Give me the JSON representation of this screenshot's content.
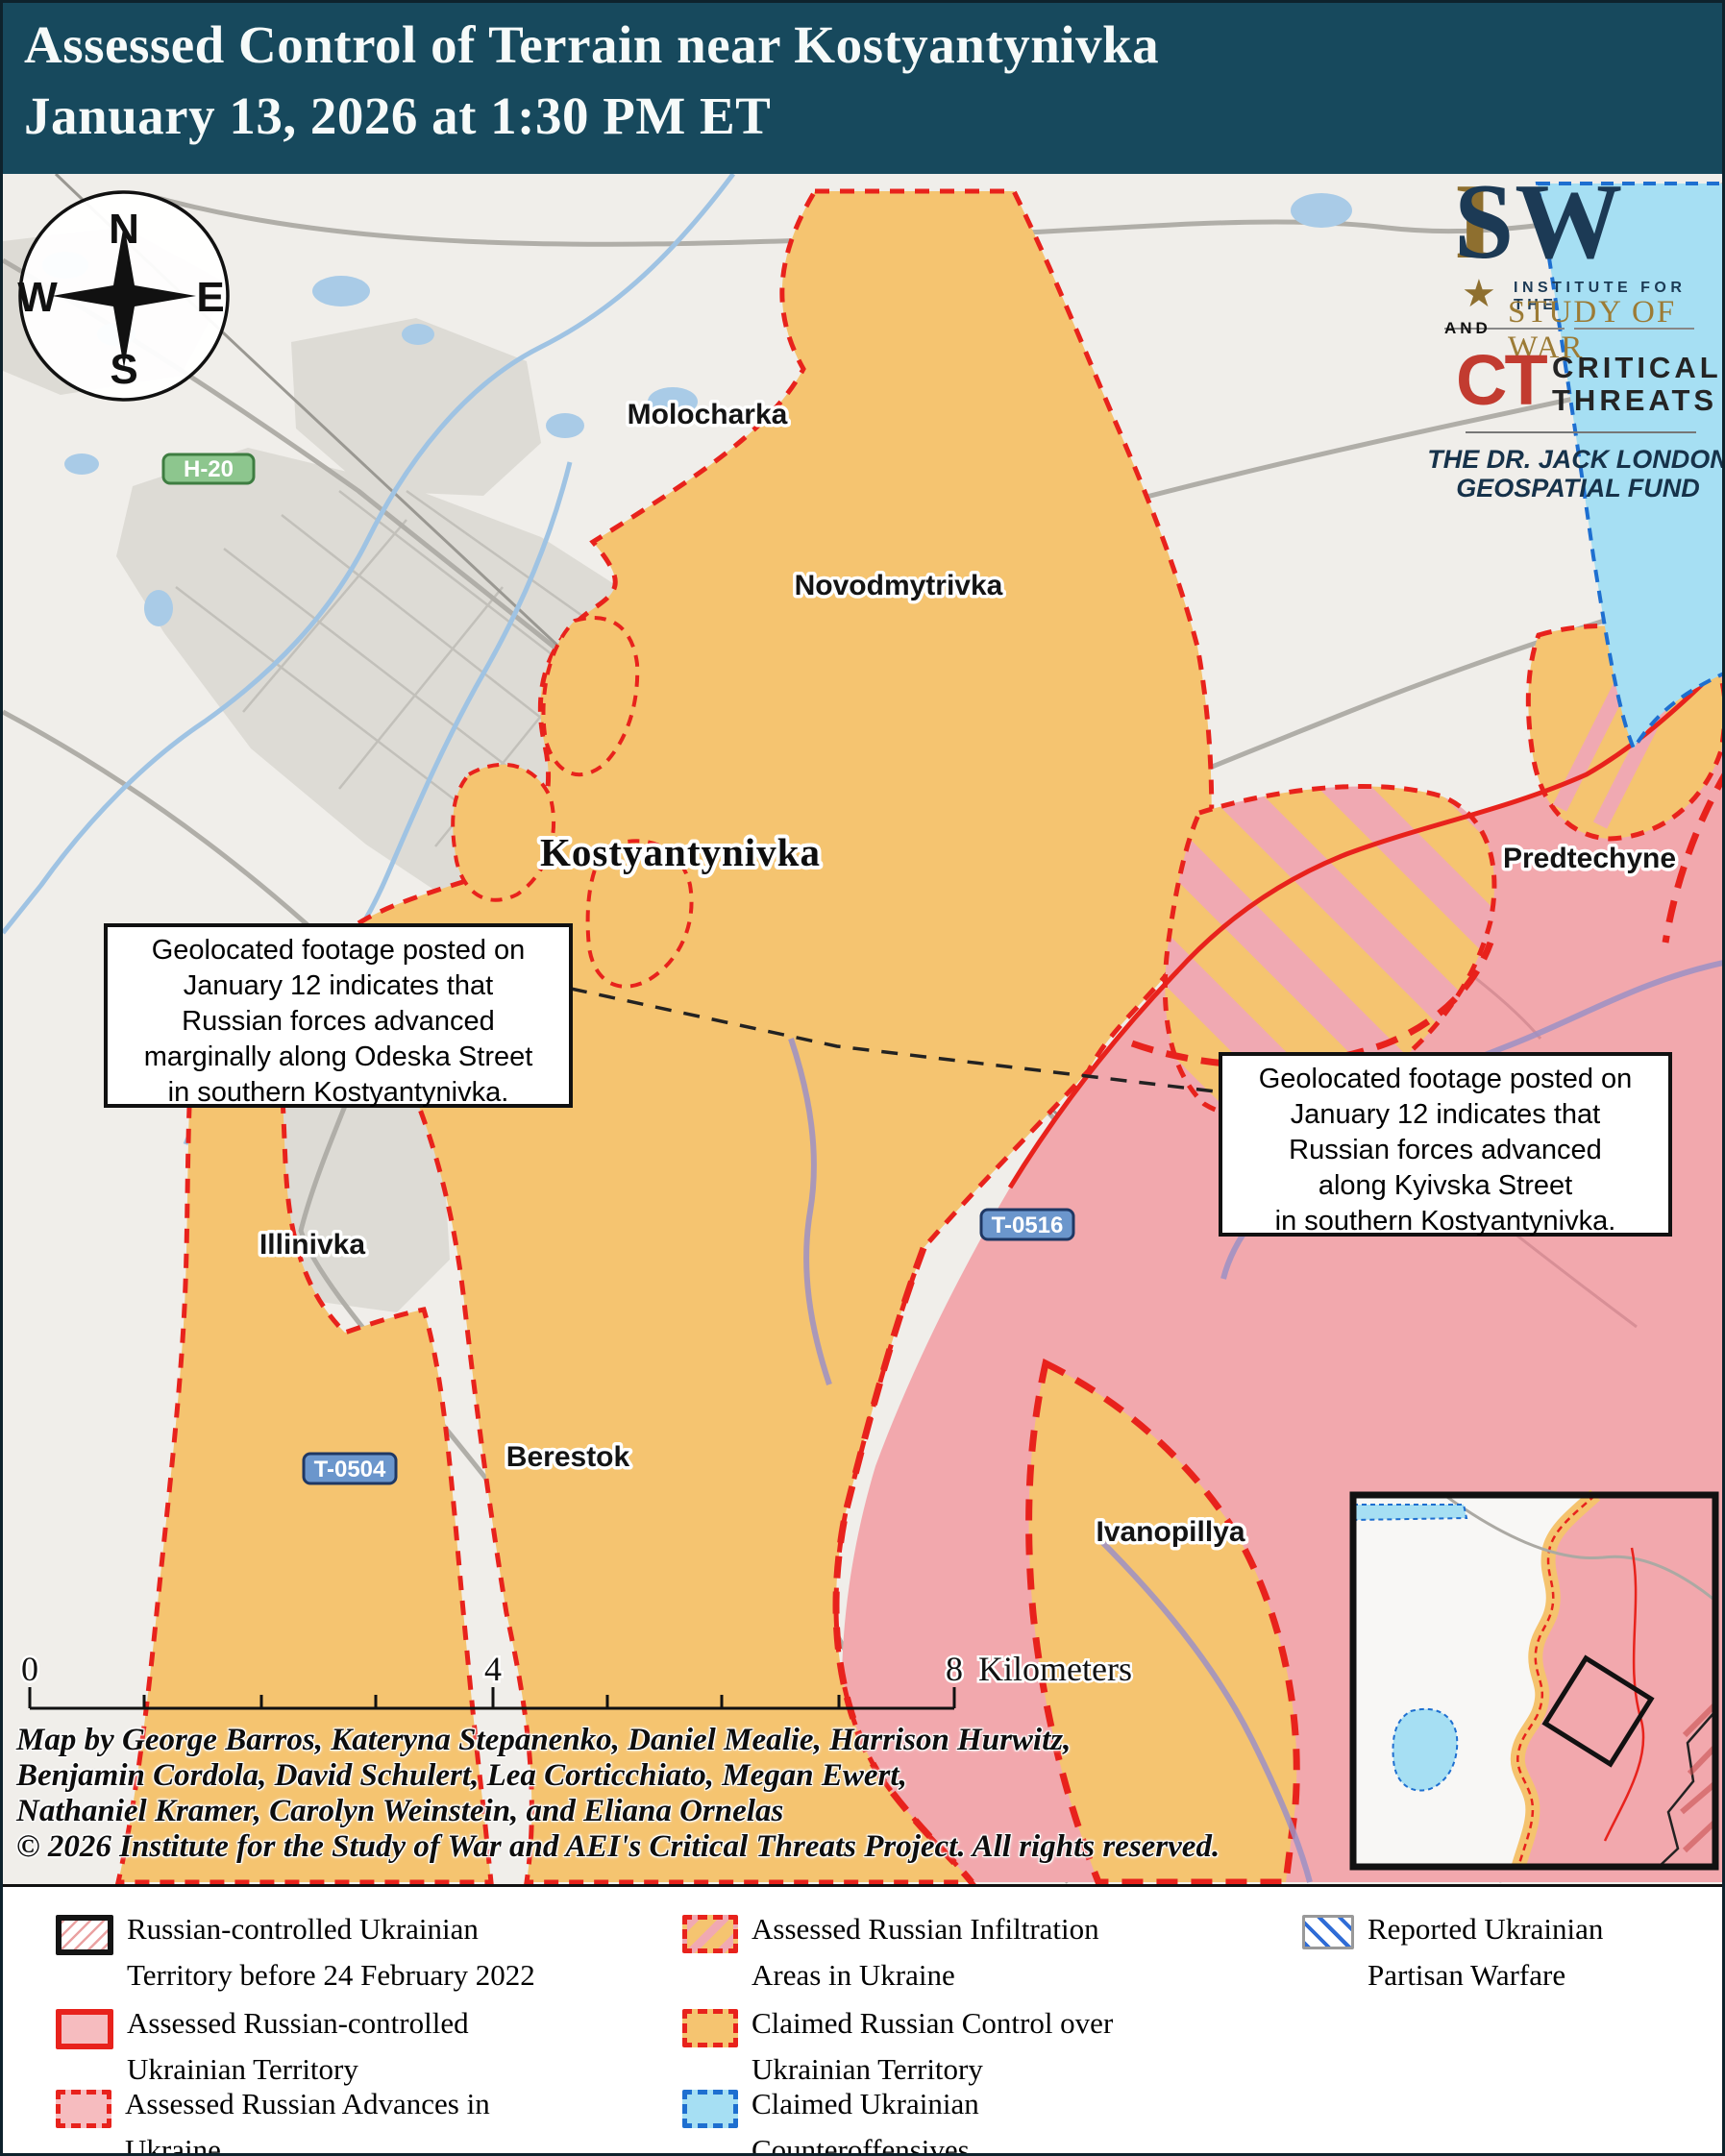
{
  "header": {
    "line1": "Assessed Control of Terrain near Kostyantynivka",
    "line2": "January 13, 2026 at 1:30 PM ET"
  },
  "branding": {
    "isw_i": "I",
    "isw_sw": "SW",
    "star_icon": "isw-star",
    "institute_line": "INSTITUTE FOR THE",
    "study_line": "STUDY OF WAR",
    "and_label": "AND",
    "ct_mark": "CT",
    "ct_line1": "CRITICAL",
    "ct_line2": "THREATS",
    "fund_line1": "THE DR. JACK LONDON",
    "fund_line2": "GEOSPATIAL FUND"
  },
  "compass": {
    "n": "N",
    "e": "E",
    "s": "S",
    "w": "W"
  },
  "map": {
    "places": [
      {
        "name": "Molocharka"
      },
      {
        "name": "Novodmytrivka"
      },
      {
        "name": "Kostyantynivka"
      },
      {
        "name": "Predtechyne"
      },
      {
        "name": "Illinivka"
      },
      {
        "name": "Berestok"
      },
      {
        "name": "Ivanopillya"
      }
    ],
    "roads": [
      {
        "label": "H-20",
        "type": "highway-green"
      },
      {
        "label": "T-0516",
        "type": "route-blue"
      },
      {
        "label": "T-0504",
        "type": "route-blue"
      }
    ],
    "callouts": [
      {
        "text": "Geolocated footage posted on\nJanuary 12 indicates that\nRussian forces advanced\nmarginally along Odeska Street\nin southern Kostyantynivka."
      },
      {
        "text": "Geolocated footage posted on\nJanuary 12 indicates that\nRussian forces advanced\nalong Kyivska Street\nin southern Kostyantynivka."
      }
    ],
    "scalebar": {
      "zero": "0",
      "four": "4",
      "eight": "8",
      "unit": "Kilometers"
    },
    "credits": {
      "line1": "Map by George Barros, Kateryna Stepanenko, Daniel Mealie, Harrison Hurwitz,",
      "line2": "Benjamin Cordola, David Schulert, Lea Corticchiato, Megan Ewert,",
      "line3": "Nathaniel Kramer, Carolyn Weinstein, and Eliana Ornelas",
      "line4": "© 2026 Institute for the Study of War and AEI's Critical Threats Project. All rights reserved."
    }
  },
  "legend": {
    "items": [
      {
        "label": "Russian-controlled Ukrainian\nTerritory before 24 February 2022"
      },
      {
        "label": "Assessed Russian-controlled\nUkrainian Territory"
      },
      {
        "label": "Assessed Russian Advances in\nUkraine"
      },
      {
        "label": "Assessed Russian Infiltration\nAreas in Ukraine"
      },
      {
        "label": "Claimed Russian Control over\nUkrainian Territory"
      },
      {
        "label": "Claimed Ukrainian\nCounteroffensives"
      },
      {
        "label": "Reported Ukrainian\nPartisan Warfare"
      }
    ]
  },
  "colors": {
    "header_bg": "#17495D",
    "claimed_russian_orange": "#F5C470",
    "assessed_russian_pink": "#F2A8AD",
    "infiltration_stripe_pink": "#F0A9B2",
    "counteroffensive_cyan": "#A6DFF3",
    "russian_border_red": "#E8221C",
    "ukrainian_border_blue": "#1E6FD0",
    "isw_gold": "#8E6F2F",
    "isw_navy": "#1C3A55",
    "ct_red": "#C23B30"
  }
}
